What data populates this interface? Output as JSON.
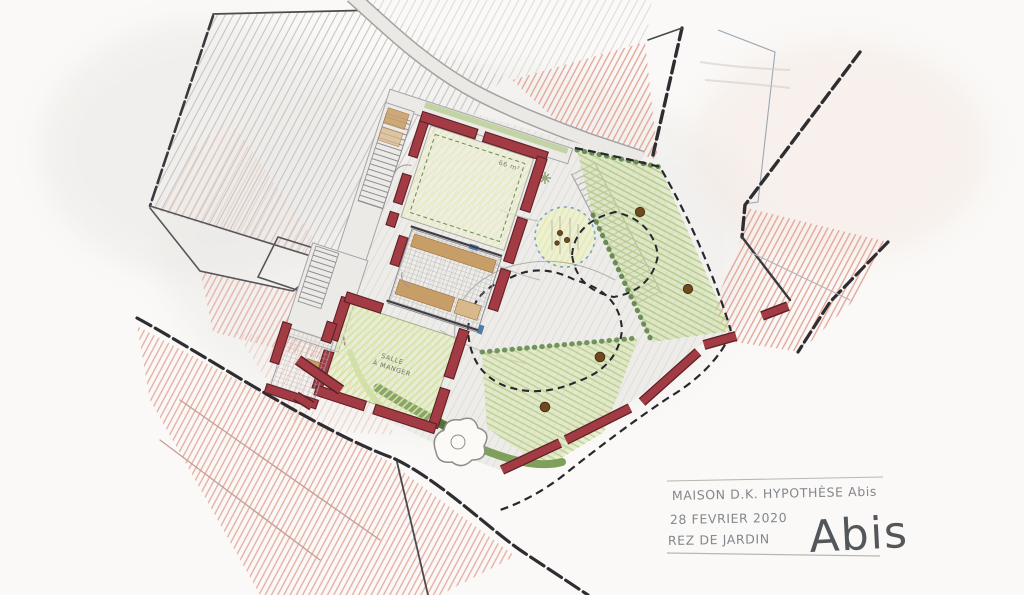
{
  "annotations": {
    "title_line": "MAISON D.K. HYPOTHÈSE Abis",
    "date_line": "28 FEVRIER 2020",
    "street_line": "REZ DE JARDIN",
    "version_stamp": "Abis"
  },
  "plan_labels": {
    "upper_courtyard_area": "66 m²",
    "room_line1": "SALLE",
    "room_line2": "À MANGER"
  },
  "palette": {
    "paper": "#faf9f7",
    "pencil_gray": "#8a8885",
    "boundary_ink": "#2e2d31",
    "wall_red": "#a23b43",
    "neighbor_pink": "#e2a193",
    "lawn_pale": "#f2f3d8",
    "lawn_mid": "#e4edb6",
    "garden_green": "#cfdfa2",
    "hedge_green": "#567e41",
    "tree_trunk_brown": "#6f4a20",
    "tree_ring_blue": "#79a2c8",
    "deck_tan": "#c89e68",
    "accent_blue": "#4f7ca6",
    "handwriting_gray": "#84878c"
  }
}
